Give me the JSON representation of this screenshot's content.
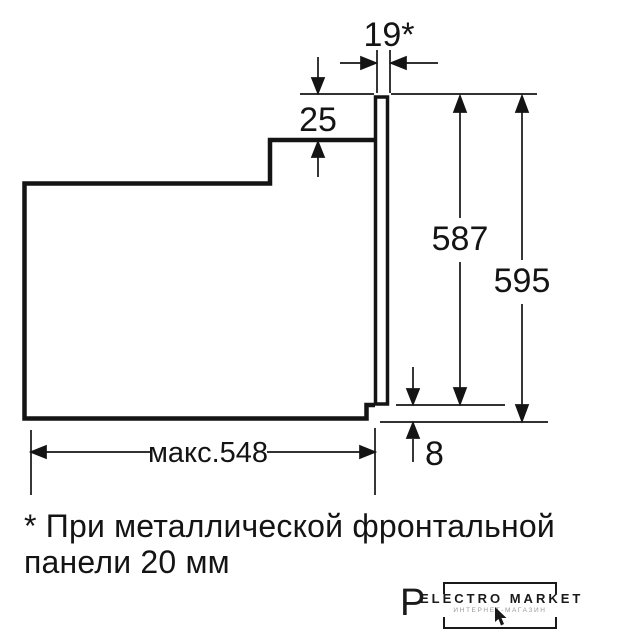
{
  "colors": {
    "ink": "#141414",
    "background": "#ffffff",
    "watermark_subtitle": "#9a9a9a"
  },
  "diagram": {
    "subject": "built-in-oven-side-profile-installation-dimensions",
    "labels": {
      "front_panel_thickness": "19*",
      "top_clearance": "25",
      "body_height": "587",
      "total_height": "595",
      "bottom_clearance": "8",
      "max_depth": "макс.548"
    },
    "footnote": {
      "line1": "* При металлической фронтальной",
      "line2": "панели 20 мм"
    }
  },
  "watermark": {
    "letter": "P",
    "brand": "ELECTRO MARKET",
    "subtitle": "ИНТЕРНЕТ-МАГАЗИН"
  }
}
